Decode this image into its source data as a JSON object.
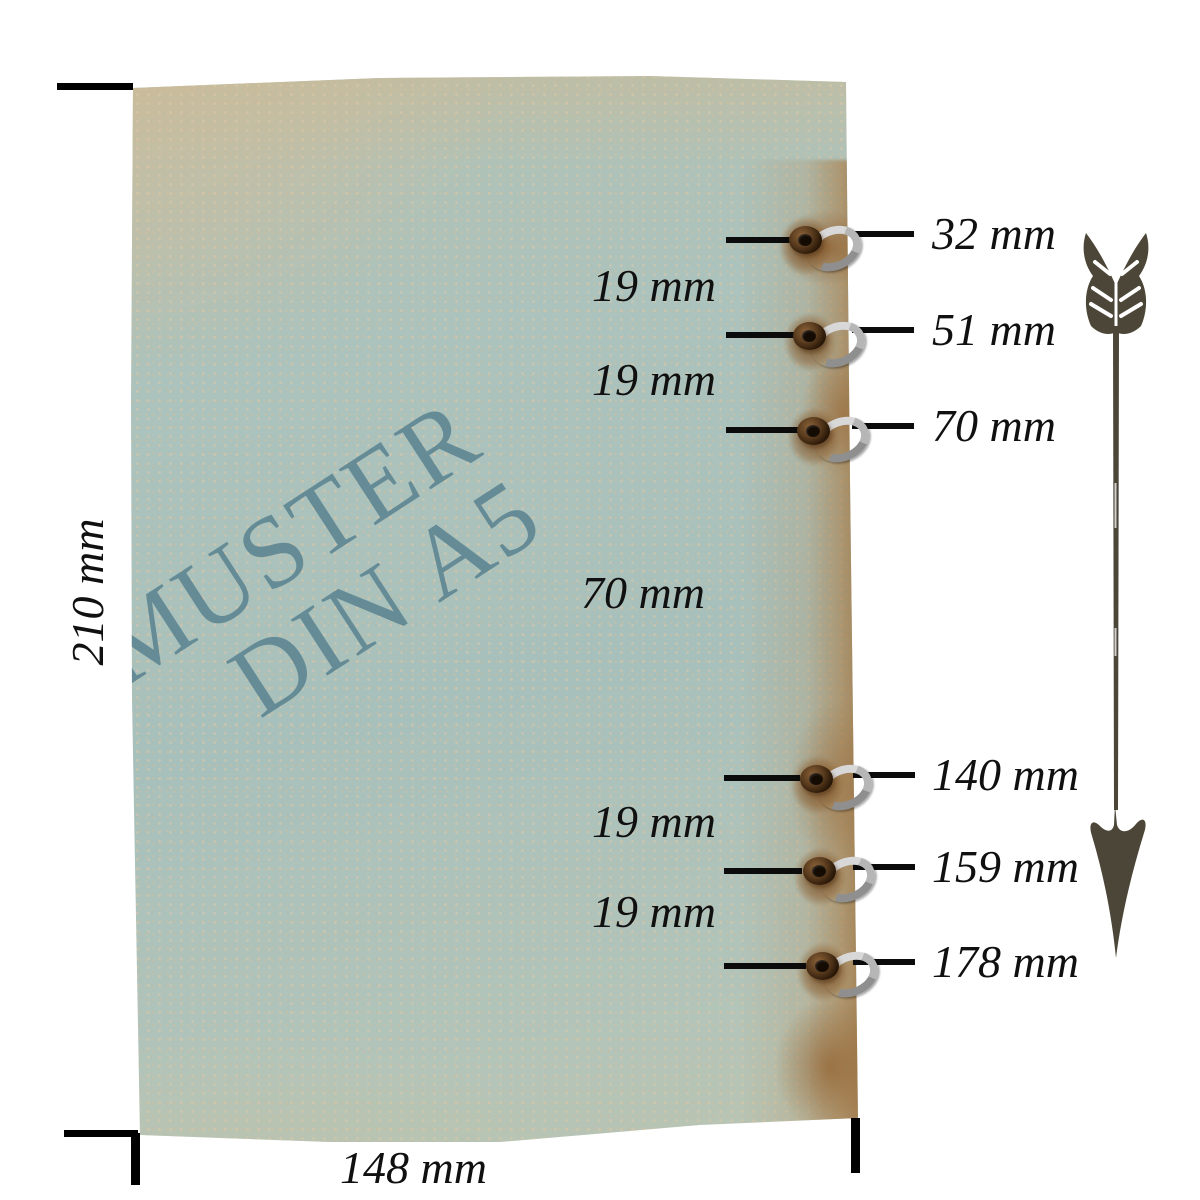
{
  "watermark": {
    "line1": "MUSTER",
    "line2": "DIN A5"
  },
  "sheet": {
    "height_label": "210 mm",
    "width_label": "148 mm"
  },
  "holes": [
    {
      "label": "32 mm"
    },
    {
      "label": "51 mm"
    },
    {
      "label": "70 mm"
    },
    {
      "label": "140 mm"
    },
    {
      "label": "159 mm"
    },
    {
      "label": "178 mm"
    }
  ],
  "gaps": [
    {
      "label": "19 mm"
    },
    {
      "label": "19 mm"
    },
    {
      "label": "70 mm"
    },
    {
      "label": "19 mm"
    },
    {
      "label": "19 mm"
    }
  ],
  "icons": {
    "arrow": "arrow-down-icon",
    "eyelet": "grommet-icon",
    "ring": "binder-ring-icon"
  },
  "colors": {
    "paper_teal": "#aac1bb",
    "paper_beige": "#ccbc9c",
    "stain_brown": "#a0713d",
    "watermark_teal": "#56808f",
    "arrow_olive": "#4b4637",
    "measure_line": "#0b0b0b",
    "metal_ring": "#b6b6b6",
    "grommet_brown": "#3c2812"
  }
}
